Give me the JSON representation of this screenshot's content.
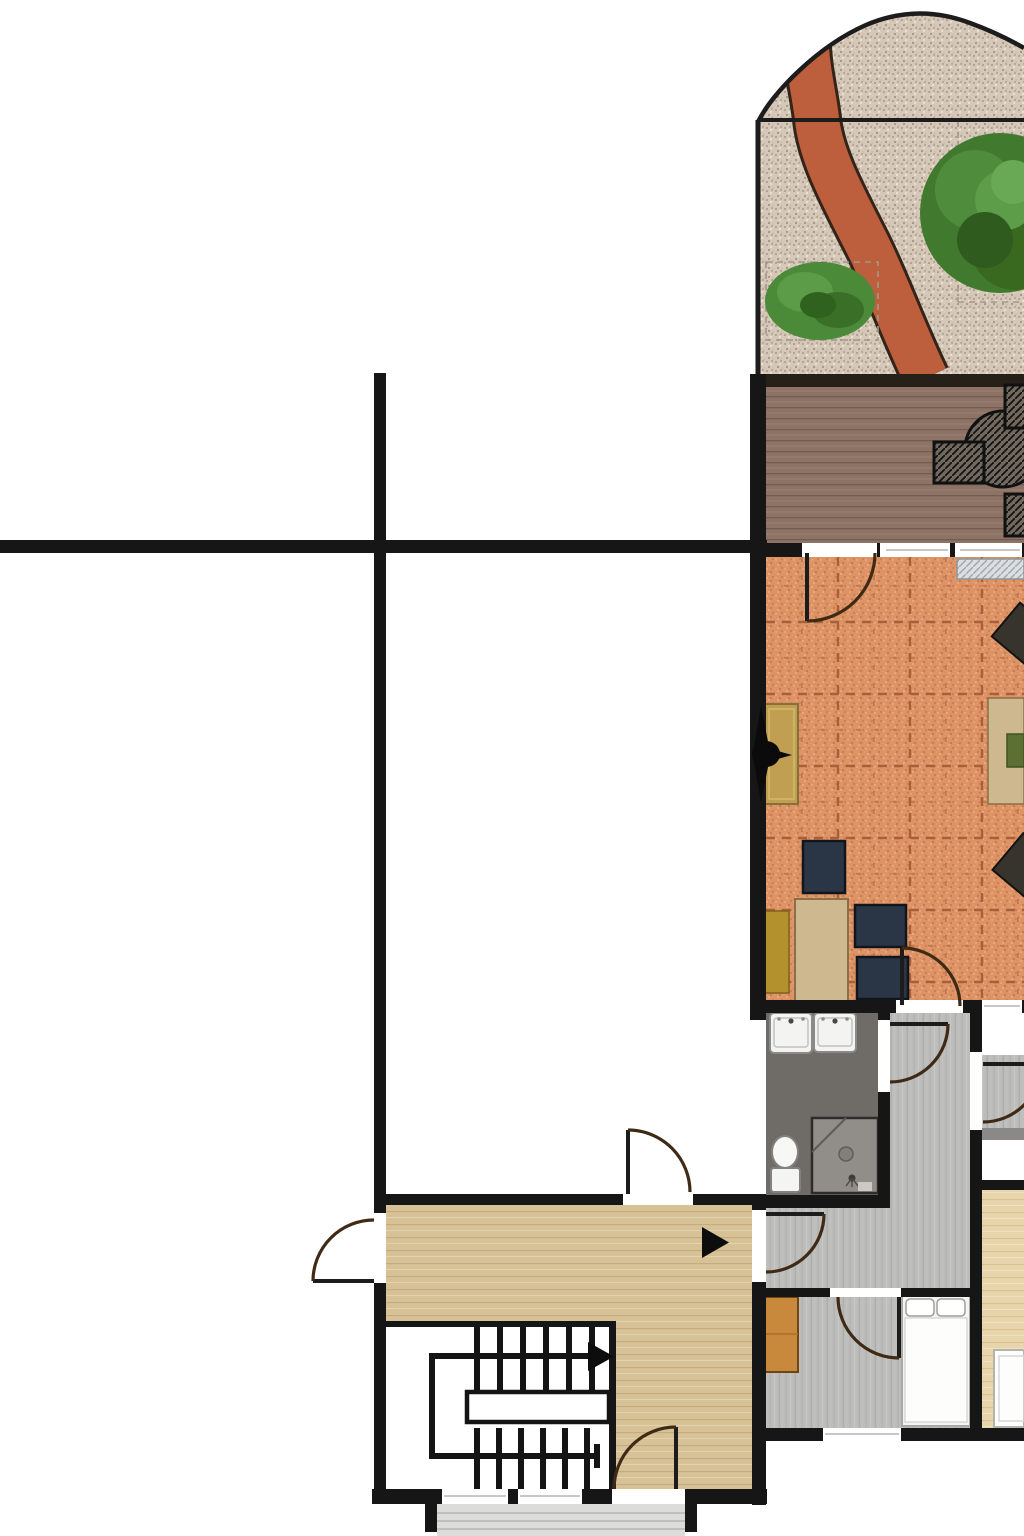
{
  "meta": {
    "kind": "architectural-floor-plan",
    "visible_text": []
  },
  "palette": {
    "background": "#ffffff",
    "wall": "#161616",
    "garden_gravel": "#d5c8b9",
    "garden_path_red": "#bd5f3c",
    "shrub_green": "#4a8a38",
    "tree_green": "#41792f",
    "deck_wood": "#8c7365",
    "living_tile_terracotta": "#dd9365",
    "tile_grout": "#a7603a",
    "bathroom_floor": "#6f6b67",
    "shower_tray": "#918e8a",
    "hall_wood_gray": "#bdbdbb",
    "stair_hall_wood_beige": "#d7c298",
    "right_room_wood_beige": "#e8d5ac",
    "dining_table_tan": "#cdb88f",
    "chair_navy": "#2a3645",
    "sideboard_mustard": "#b3912c",
    "bedroom_cabinet_orange": "#c9893c",
    "door_arc": "#3f2a15",
    "porch_concrete": "#dcdcda",
    "fixture_white": "#f3f3f1"
  },
  "icons": {
    "stairs_direction_arrow": "black right-pointing triangle",
    "hall_direction_arrow": "black right-pointing triangle"
  }
}
